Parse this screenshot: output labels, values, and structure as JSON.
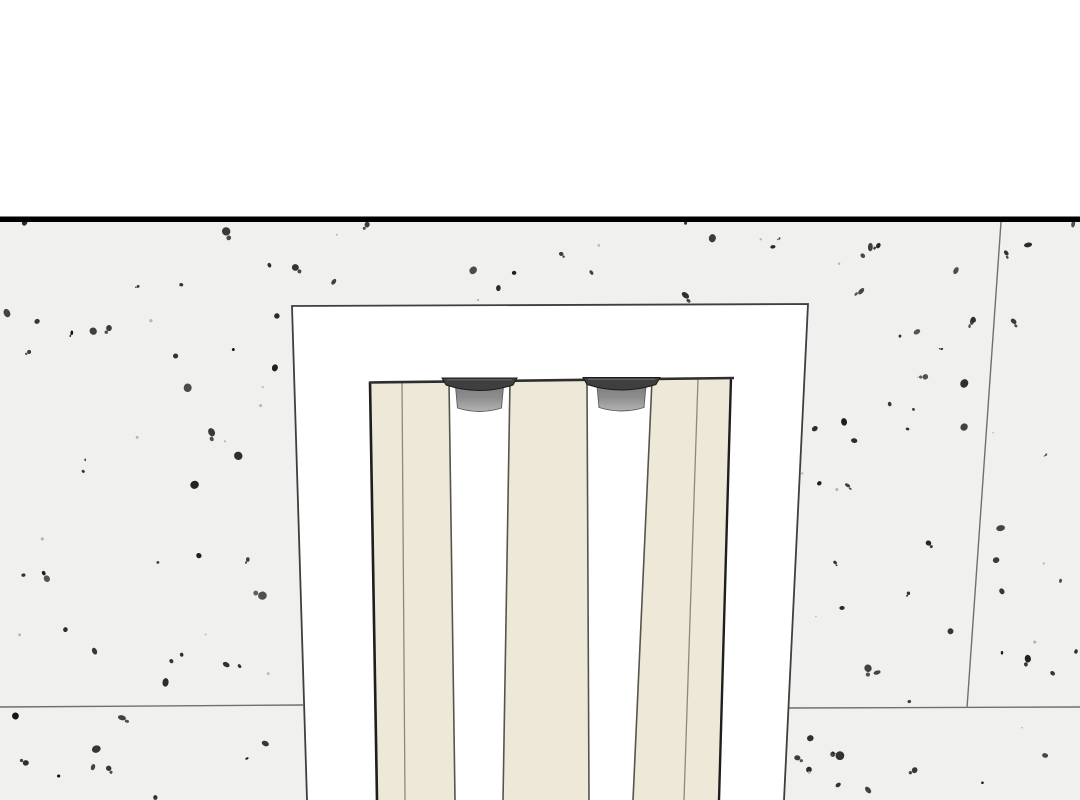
{
  "meta": {
    "title": "Illustration of a speckled wall with a recessed niche holding cream vertical panels and two gray top rollers",
    "canvas": {
      "width": 1080,
      "height": 800
    }
  },
  "colors": {
    "background": "#ffffff",
    "wall": "#f0f0ee",
    "divider": "#000000",
    "wall_seam": "#6f6f6f",
    "recess_fill": "#ffffff",
    "recess_border": "#3f3f3f",
    "panel_fill": "#ede8d8",
    "panel_edge_dark": "#1e1e1e",
    "panel_edge": "#56544c",
    "panel_seam": "#8b897f",
    "panel_top_line": "#2e2e2e",
    "flange_fill": "#3f3f42",
    "flange_outline": "#1c1c1c",
    "flange_highlight": "#6e6e6e",
    "cylinder_top": "#7f7f7f",
    "cylinder_mid": "#8d8d8d",
    "cylinder_low": "#a6a6a6",
    "cylinder_bottom": "#b2b2b2",
    "cylinder_outline": "#5a5a5a",
    "speckle_dark": [
      "#101010",
      "#1d1d1d",
      "#2b2b2b"
    ],
    "speckle_light": "#aeaeae"
  },
  "geometry": {
    "divider": {
      "x": 0,
      "y": 216.5,
      "width": 1080,
      "thickness": 5.5
    },
    "wall_band": {
      "x": 0,
      "top": 222,
      "width": 1080,
      "bottom": 800
    },
    "wall_seams": [
      {
        "x1": 1001,
        "y1": 222,
        "x2": 967,
        "y2": 708
      },
      {
        "x1": 786,
        "y1": 708,
        "x2": 1080,
        "y2": 707
      },
      {
        "x1": 0,
        "y1": 707,
        "x2": 303,
        "y2": 705
      }
    ],
    "recess": {
      "path": "M307 800 L292 306 L808 304 L784 800",
      "border_width": 1.8
    },
    "panel_top_line": {
      "x1": 369,
      "y1": 382.5,
      "x2": 734,
      "y2": 378,
      "width": 2.6
    },
    "panels": [
      {
        "name": "panel-left",
        "points": "370,382 449,381 455,800 377,800",
        "left_edge": {
          "x1": 370,
          "y1": 382,
          "x2": 377,
          "y2": 800,
          "width": 2.6,
          "dark": true
        },
        "right_edge": {
          "x1": 449,
          "y1": 381,
          "x2": 455,
          "y2": 800,
          "width": 1.6,
          "dark": false
        },
        "seam": {
          "x1": 402,
          "y1": 382,
          "x2": 405,
          "y2": 800
        }
      },
      {
        "name": "panel-middle",
        "points": "510,381 587,380 589,800 503,800",
        "left_edge": {
          "x1": 510,
          "y1": 381,
          "x2": 503,
          "y2": 800,
          "width": 1.6,
          "dark": false
        },
        "right_edge": {
          "x1": 587,
          "y1": 380,
          "x2": 589,
          "y2": 800,
          "width": 1.6,
          "dark": false
        },
        "seam": null
      },
      {
        "name": "panel-right",
        "points": "652,380 731,378 719,800 633,800",
        "left_edge": {
          "x1": 652,
          "y1": 380,
          "x2": 633,
          "y2": 800,
          "width": 1.6,
          "dark": false
        },
        "right_edge": {
          "x1": 731,
          "y1": 378,
          "x2": 719,
          "y2": 800,
          "width": 2.4,
          "dark": true
        },
        "seam": {
          "x1": 698,
          "y1": 379,
          "x2": 684,
          "y2": 800
        }
      }
    ],
    "rollers": [
      {
        "name": "roller-left",
        "cx": 479.5,
        "flange_half_width": 37.5,
        "flange_top": 378,
        "flange_drop": 18,
        "cyl_half_top": 24,
        "cyl_half_bottom": 22,
        "cyl_top": 386,
        "cyl_bottom": 408,
        "cyl_arc": 7
      },
      {
        "name": "roller-right",
        "cx": 621.5,
        "flange_half_width": 38.5,
        "flange_top": 377.5,
        "flange_drop": 18,
        "cyl_half_top": 24.5,
        "cyl_half_bottom": 22.5,
        "cyl_top": 385.5,
        "cyl_bottom": 407.5,
        "cyl_arc": 7
      }
    ],
    "speckles": {
      "seed": 1337421,
      "dark_count": 175,
      "light_count": 38,
      "companion_chance": 0.3,
      "min_rx": 1.3,
      "max_extra_rx": 3.2
    }
  }
}
